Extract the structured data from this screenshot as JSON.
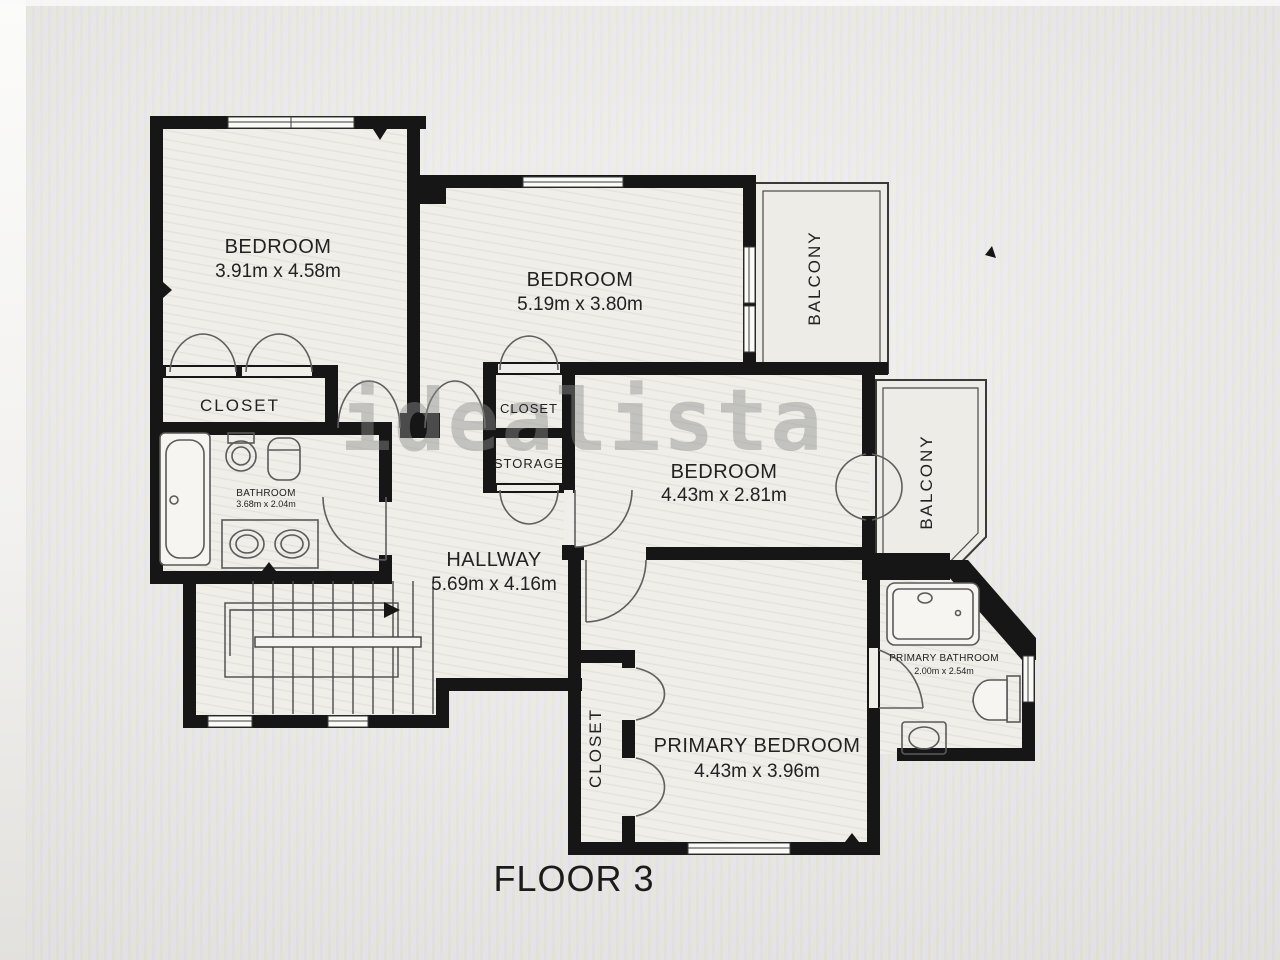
{
  "floor_plan": {
    "floor_label": "FLOOR 3",
    "watermark": "idealista",
    "colors": {
      "wall": "#161616",
      "floor": "#efeee8",
      "fixture_line": "#5a5a5a",
      "watermark_gray": "#8d8d8d",
      "label_text": "#222222",
      "background": "#e9e8e5"
    },
    "rooms": {
      "bedroom_top_left": {
        "name": "BEDROOM",
        "dims": "3.91m x 4.58m"
      },
      "bedroom_top_middle": {
        "name": "BEDROOM",
        "dims": "5.19m x 3.80m"
      },
      "bedroom_middle_right": {
        "name": "BEDROOM",
        "dims": "4.43m x 2.81m"
      },
      "primary_bedroom": {
        "name": "PRIMARY BEDROOM",
        "dims": "4.43m x 3.96m"
      },
      "hallway": {
        "name": "HALLWAY",
        "dims": "5.69m x 4.16m"
      },
      "bathroom": {
        "name": "BATHROOM",
        "dims": "3.68m x 2.04m"
      },
      "primary_bathroom": {
        "name": "PRIMARY BATHROOM",
        "dims": "2.00m x 2.54m"
      },
      "closet_bedroom_top_left": {
        "name": "CLOSET"
      },
      "closet_hall": {
        "name": "CLOSET"
      },
      "storage": {
        "name": "STORAGE"
      },
      "closet_primary": {
        "name": "CLOSET"
      },
      "balcony_top": {
        "name": "BALCONY"
      },
      "balcony_right": {
        "name": "BALCONY"
      }
    }
  }
}
